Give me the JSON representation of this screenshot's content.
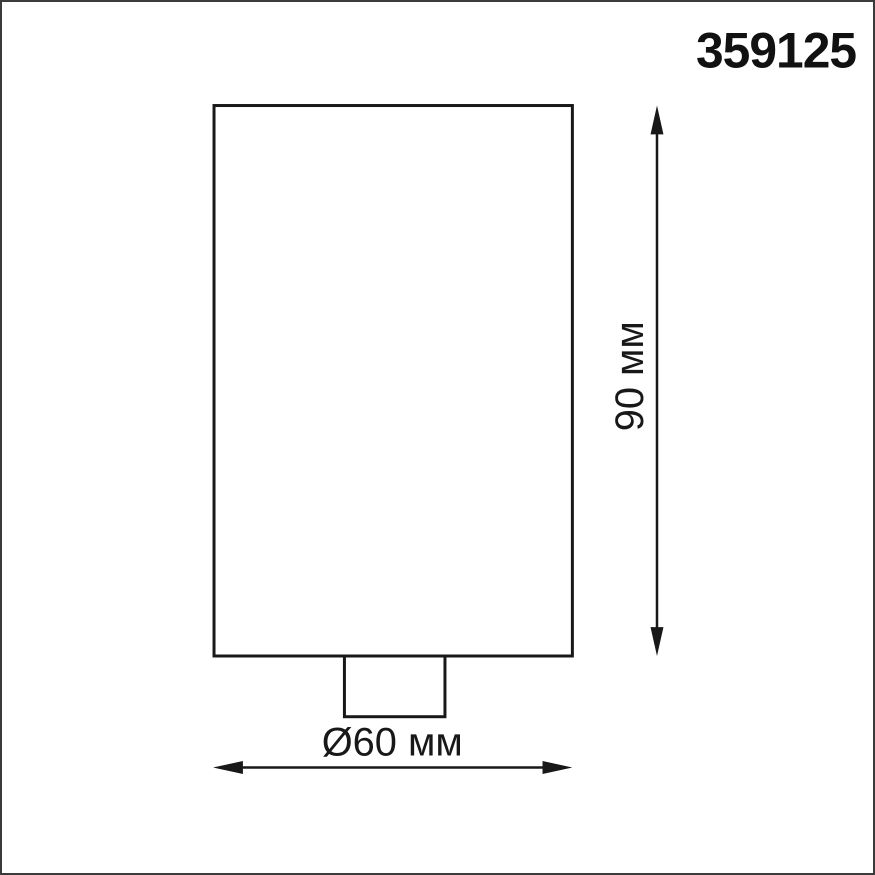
{
  "page": {
    "background_color": "#ffffff",
    "border_color": "#3b3b3b"
  },
  "header": {
    "product_code": "359125"
  },
  "diagram": {
    "line_color": "#181818",
    "height_dimension": {
      "label": "90 мм",
      "value": 90,
      "unit": "мм"
    },
    "diameter_dimension": {
      "label": "Ø60 мм",
      "value": 60,
      "unit": "мм"
    }
  }
}
